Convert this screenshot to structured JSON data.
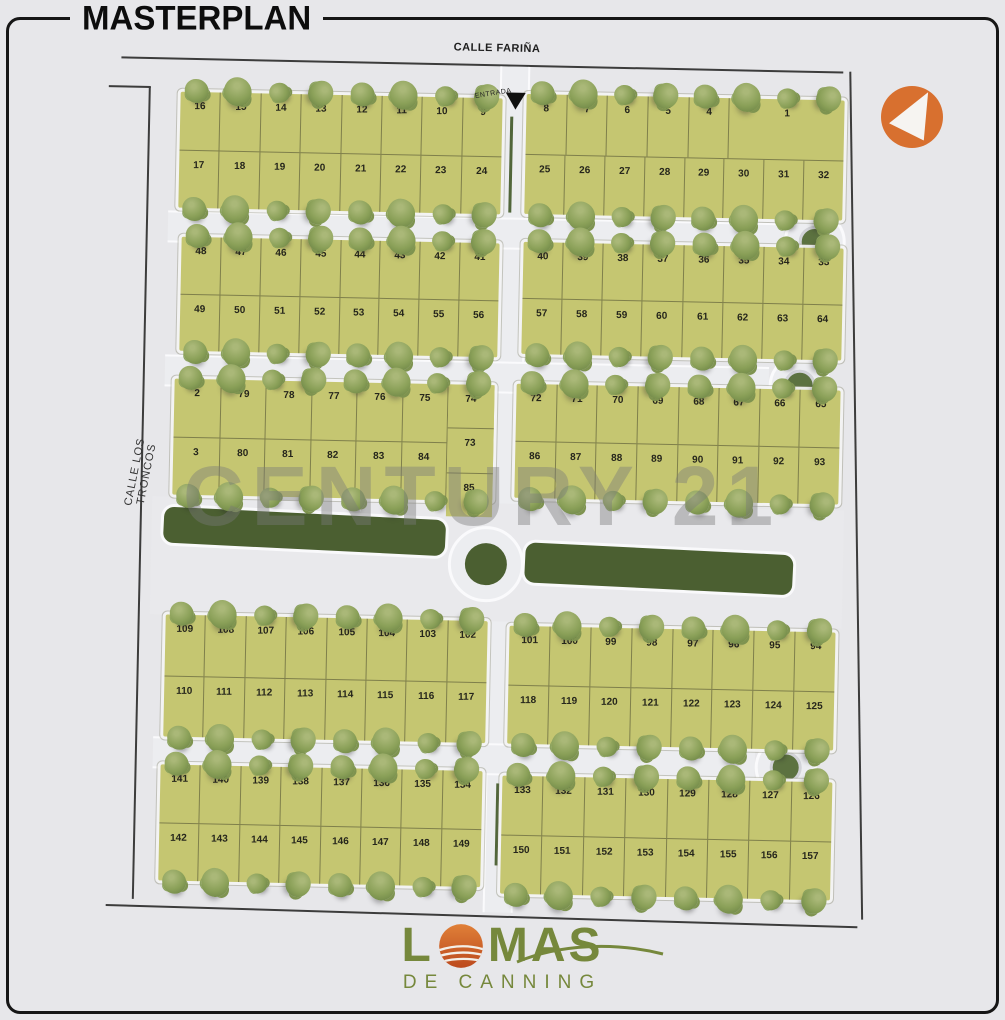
{
  "title": "MASTERPLAN",
  "watermark": "CENTURY 21",
  "streets": {
    "top": "CALLE FARIÑA",
    "left": "CALLE LOS TRONCOS",
    "entrance_label": "ENTRADA"
  },
  "logo": {
    "prefix": "L",
    "suffix": "MAS",
    "subtitle": "DE CANNING"
  },
  "icons": {
    "c21_arrow": "left-triangle-icon",
    "entrance_marker": "down-triangle-icon"
  },
  "colors": {
    "lot_fill": "#c5c671",
    "tree_green": "#8aa058",
    "park_green": "#4b5f31",
    "road_gray": "#ecedf0",
    "background_gray": "#e7e7ea",
    "accent_orange": "#d8702f",
    "logo_green": "#76883c",
    "watermark_gray": "#7a7a7a",
    "outline_black": "#161616"
  },
  "blocks": [
    {
      "id": "block-1-left",
      "x": 80,
      "y": 60,
      "w": 322,
      "h": 116,
      "rows": [
        [
          "16",
          "15",
          "14",
          "13",
          "12",
          "11",
          "10",
          "9"
        ],
        [
          "17",
          "18",
          "19",
          "20",
          "21",
          "22",
          "23",
          "24"
        ]
      ]
    },
    {
      "id": "block-1-right",
      "x": 426,
      "y": 55,
      "w": 318,
      "h": 120,
      "rows": [
        [
          "8",
          "7",
          "6",
          "5",
          "4",
          {
            "t": "1",
            "f": 2.9
          }
        ],
        [
          "25",
          "26",
          "27",
          "28",
          "29",
          "30",
          "31",
          "32"
        ]
      ]
    },
    {
      "id": "block-2-left",
      "x": 84,
      "y": 205,
      "w": 318,
      "h": 114,
      "rows": [
        [
          "48",
          "47",
          "46",
          "45",
          "44",
          "43",
          "42",
          "41"
        ],
        [
          "49",
          "50",
          "51",
          "52",
          "53",
          "54",
          "55",
          "56"
        ]
      ]
    },
    {
      "id": "block-2-right",
      "x": 426,
      "y": 203,
      "w": 320,
      "h": 112,
      "rows": [
        [
          "40",
          "39",
          "38",
          "37",
          "36",
          "35",
          "34",
          "33"
        ],
        [
          "57",
          "58",
          "59",
          "60",
          "61",
          "62",
          "63",
          "64"
        ]
      ]
    },
    {
      "id": "block-3-left",
      "x": 80,
      "y": 347,
      "w": 320,
      "h": 116,
      "layout": "threecol",
      "left": [
        "2",
        "3"
      ],
      "mid": [
        [
          "79",
          "78",
          "77",
          "76",
          "75"
        ],
        [
          "80",
          "81",
          "82",
          "83",
          "84"
        ]
      ],
      "right": [
        "74",
        "73",
        "85"
      ]
    },
    {
      "id": "block-3-right",
      "x": 422,
      "y": 345,
      "w": 324,
      "h": 114,
      "rows": [
        [
          "72",
          "71",
          "70",
          "69",
          "68",
          "67",
          "66",
          "65"
        ],
        [
          "86",
          "87",
          "88",
          "89",
          "90",
          "91",
          "92",
          "93"
        ]
      ]
    },
    {
      "id": "block-4-left",
      "x": 76,
      "y": 583,
      "w": 322,
      "h": 122,
      "rows": [
        [
          "109",
          "108",
          "107",
          "106",
          "105",
          "104",
          "103",
          "102"
        ],
        [
          "110",
          "111",
          "112",
          "113",
          "114",
          "115",
          "116",
          "117"
        ]
      ]
    },
    {
      "id": "block-4-right",
      "x": 420,
      "y": 587,
      "w": 326,
      "h": 118,
      "rows": [
        [
          "101",
          "100",
          "99",
          "98",
          "97",
          "96",
          "95",
          "94"
        ],
        [
          "118",
          "119",
          "120",
          "121",
          "122",
          "123",
          "124",
          "125"
        ]
      ]
    },
    {
      "id": "block-5-left",
      "x": 74,
      "y": 733,
      "w": 322,
      "h": 116,
      "rows": [
        [
          "141",
          "140",
          "139",
          "138",
          "137",
          "136",
          "135",
          "134"
        ],
        [
          "142",
          "143",
          "144",
          "145",
          "146",
          "147",
          "148",
          "149"
        ]
      ]
    },
    {
      "id": "block-5-right",
      "x": 416,
      "y": 737,
      "w": 330,
      "h": 118,
      "rows": [
        [
          "133",
          "132",
          "131",
          "130",
          "129",
          "128",
          "127",
          "126"
        ],
        [
          "150",
          "151",
          "152",
          "153",
          "154",
          "155",
          "156",
          "157"
        ]
      ]
    }
  ]
}
